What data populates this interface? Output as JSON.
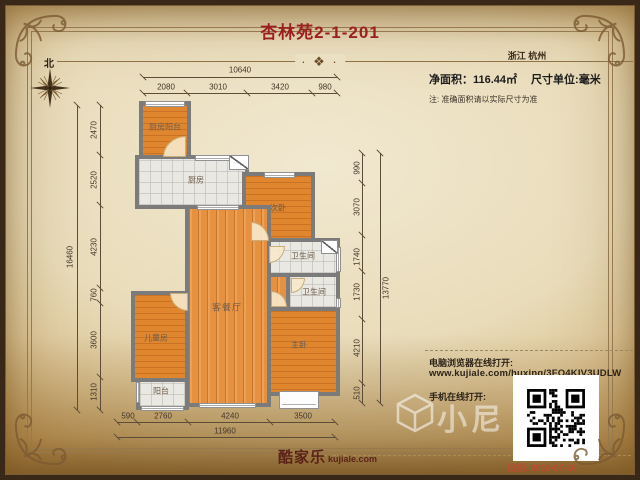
{
  "header": {
    "title": "杏林苑2-1-201",
    "location": "浙江 杭州"
  },
  "info": {
    "area_text": "净面积：116.44㎡",
    "unit_text": "尺寸单位:毫米",
    "note": "注: 准确面积请以实际尺寸为准"
  },
  "compass": {
    "north_label": "北"
  },
  "rooms": [
    {
      "label": "厨房阳台"
    },
    {
      "label": "厨房"
    },
    {
      "label": "次卧"
    },
    {
      "label": "卫生间"
    },
    {
      "label": "卫生间"
    },
    {
      "label": "客餐厅"
    },
    {
      "label": "儿童房"
    },
    {
      "label": "主卧"
    },
    {
      "label": "阳台"
    }
  ],
  "dimensions": {
    "top": {
      "total": "10640",
      "segments": [
        "2080",
        "3010",
        "3420",
        "980"
      ]
    },
    "bottom": {
      "total": "11960",
      "segments": [
        "590",
        "2760",
        "4240",
        "3500"
      ]
    },
    "left": {
      "total": "16460",
      "segments": [
        "2470",
        "2520",
        "4230",
        "760",
        "3600",
        "1310"
      ]
    },
    "right": {
      "total": "13770",
      "segments": [
        "990",
        "3070",
        "1740",
        "1730",
        "4210",
        "510"
      ]
    }
  },
  "links": {
    "pc_label": "电脑浏览器在线打开:",
    "pc_url": "www.kujiale.com/huxing/3FO4KIV3UDLW",
    "mobile_label": "手机在线打开:"
  },
  "brand": {
    "logo_cn": "酷家乐",
    "logo_en": "kujiale.com",
    "watermark": "小尼"
  },
  "footer": {
    "date_label": "日期:",
    "date_value": "2018-07-16"
  },
  "colors": {
    "title": "#9c1f1f",
    "date": "#c04a2e",
    "wall": "#7b7b7b",
    "wood_floor": "#e0862f",
    "tile_floor": "#e9e8e2",
    "paper": "#ece3c8",
    "frame": "#3a2a18"
  }
}
